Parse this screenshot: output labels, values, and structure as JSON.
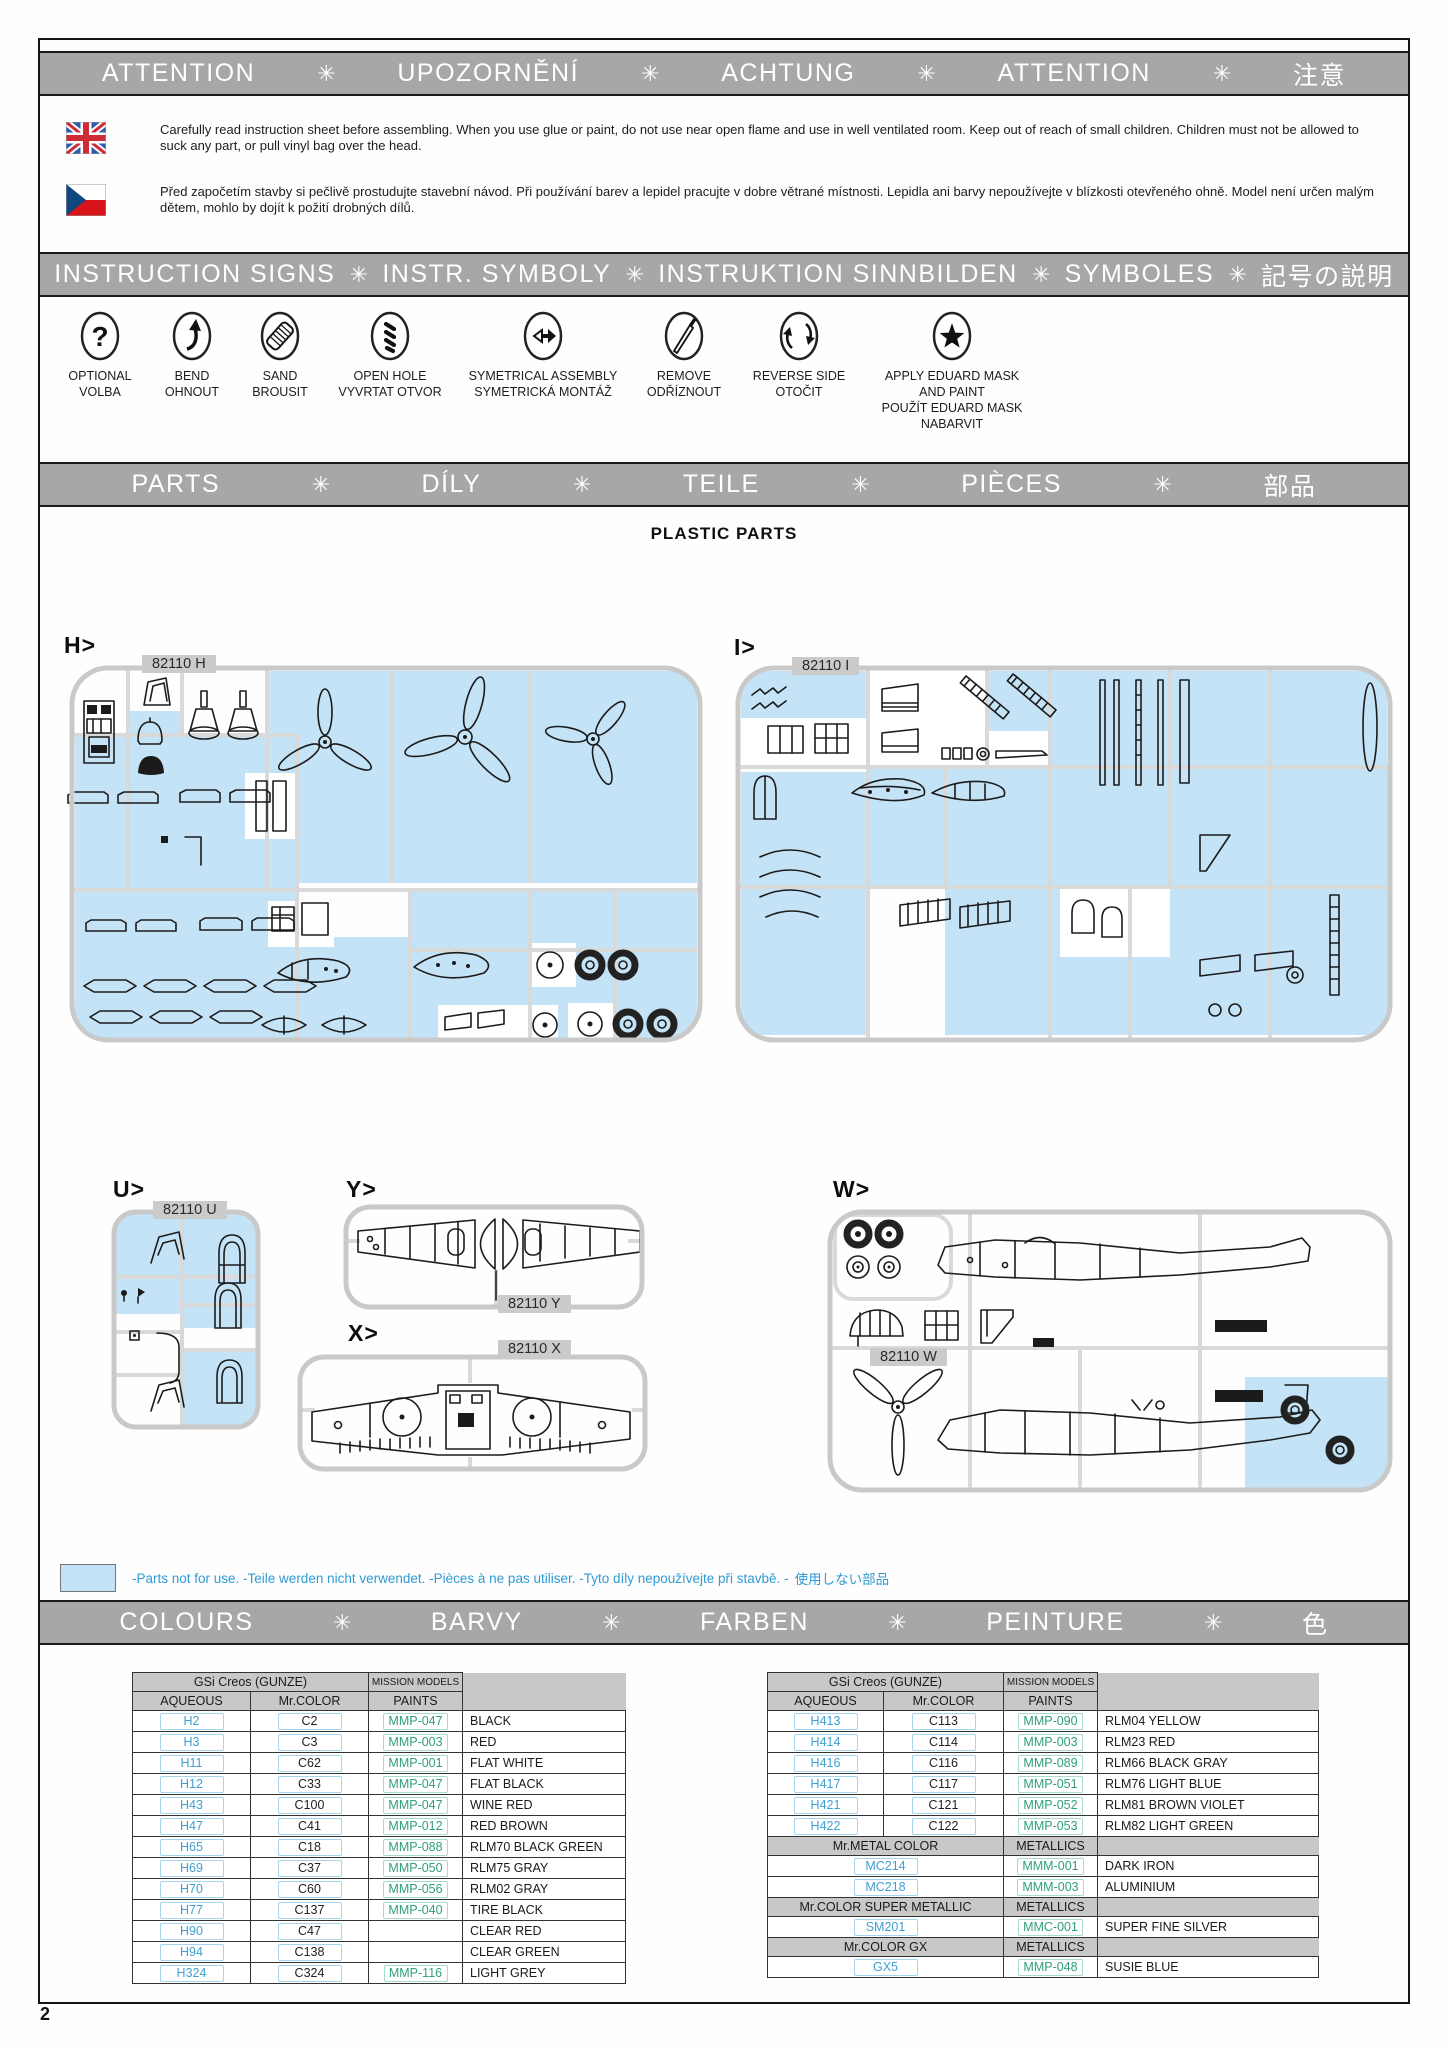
{
  "page_number": "2",
  "separator": "✳",
  "bars": {
    "attention": [
      "ATTENTION",
      "UPOZORNĚNÍ",
      "ACHTUNG",
      "ATTENTION",
      "注意"
    ],
    "instruction_signs": [
      "INSTRUCTION SIGNS",
      "INSTR. SYMBOLY",
      "INSTRUKTION  SINNBILDEN",
      "SYMBOLES",
      "記号の説明"
    ],
    "parts": [
      "PARTS",
      "DÍLY",
      "TEILE",
      "PIÈCES",
      "部品"
    ],
    "colours": [
      "COLOURS",
      "BARVY",
      "FARBEN",
      "PEINTURE",
      "色"
    ]
  },
  "warnings": {
    "english": "Carefully read instruction sheet before assembling. When you use glue or paint, do not use near open flame and use in well ventilated room. Keep out of reach of small children. Children must not be allowed to suck any part, or pull vinyl bag over the head.",
    "czech": "Před započetím stavby si pečlivě prostudujte stavební návod. Při používání barev a lepidel pracujte v dobre větrané místnosti. Lepidla ani barvy nepoužívejte v blízkosti otevřeného ohně. Model není určen malým dětem, mohlo by dojít k požití drobných dílů."
  },
  "signs": [
    {
      "id": "optional",
      "icon": "question-icon",
      "lines": [
        "OPTIONAL",
        "VOLBA"
      ]
    },
    {
      "id": "bend",
      "icon": "bend-arrow-icon",
      "lines": [
        "BEND",
        "OHNOUT"
      ]
    },
    {
      "id": "sand",
      "icon": "sanding-icon",
      "lines": [
        "SAND",
        "BROUSIT"
      ]
    },
    {
      "id": "open-hole",
      "icon": "drill-icon",
      "lines": [
        "OPEN HOLE",
        "VYVRTAT OTVOR"
      ]
    },
    {
      "id": "symmetrical-assembly",
      "icon": "symmetry-arrows-icon",
      "lines": [
        "SYMETRICAL ASSEMBLY",
        "SYMETRICKÁ MONTÁŽ"
      ]
    },
    {
      "id": "remove",
      "icon": "knife-icon",
      "lines": [
        "REMOVE",
        "ODŘÍZNOUT"
      ]
    },
    {
      "id": "reverse-side",
      "icon": "rotate-arrows-icon",
      "lines": [
        "REVERSE SIDE",
        "OTOČIT"
      ]
    },
    {
      "id": "apply-mask",
      "icon": "star-icon",
      "lines": [
        "APPLY EDUARD MASK",
        "AND PAINT",
        "POUŽÍT EDUARD MASK",
        "NABARVIT"
      ]
    }
  ],
  "parts_section": {
    "title": "PLASTIC PARTS",
    "sprues": [
      {
        "id": "h",
        "letter": "H>",
        "chip": "82110 H"
      },
      {
        "id": "i",
        "letter": "I>",
        "chip": "82110 I"
      },
      {
        "id": "u",
        "letter": "U>",
        "chip": "82110 U"
      },
      {
        "id": "y",
        "letter": "Y>",
        "chip": "82110 Y"
      },
      {
        "id": "x",
        "letter": "X>",
        "chip": "82110 X"
      },
      {
        "id": "w",
        "letter": "W>",
        "chip": "82110 W"
      }
    ],
    "note": "-Parts not for use. -Teile werden nicht verwendet. -Pièces à ne pas utiliser. -Tyto díly nepoužívejte při stavbě. -",
    "note_jp": "使用しない部品"
  },
  "paint_tables": {
    "left": {
      "group_header": "GSi Creos (GUNZE)",
      "brand_header": "MISSION MODELS",
      "columns": [
        "AQUEOUS",
        "Mr.COLOR",
        "PAINTS"
      ],
      "rows": [
        [
          "H2",
          "C2",
          "MMP-047",
          "BLACK"
        ],
        [
          "H3",
          "C3",
          "MMP-003",
          "RED"
        ],
        [
          "H11",
          "C62",
          "MMP-001",
          "FLAT WHITE"
        ],
        [
          "H12",
          "C33",
          "MMP-047",
          "FLAT BLACK"
        ],
        [
          "H43",
          "C100",
          "MMP-047",
          "WINE RED"
        ],
        [
          "H47",
          "C41",
          "MMP-012",
          "RED BROWN"
        ],
        [
          "H65",
          "C18",
          "MMP-088",
          "RLM70 BLACK GREEN"
        ],
        [
          "H69",
          "C37",
          "MMP-050",
          "RLM75 GRAY"
        ],
        [
          "H70",
          "C60",
          "MMP-056",
          "RLM02 GRAY"
        ],
        [
          "H77",
          "C137",
          "MMP-040",
          "TIRE BLACK"
        ],
        [
          "H90",
          "C47",
          "",
          "CLEAR RED"
        ],
        [
          "H94",
          "C138",
          "",
          "CLEAR GREEN"
        ],
        [
          "H324",
          "C324",
          "MMP-116",
          "LIGHT GREY"
        ]
      ]
    },
    "right": {
      "group_header": "GSi Creos (GUNZE)",
      "brand_header": "MISSION MODELS",
      "columns": [
        "AQUEOUS",
        "Mr.COLOR",
        "PAINTS"
      ],
      "rows": [
        [
          "H413",
          "C113",
          "MMP-090",
          "RLM04 YELLOW"
        ],
        [
          "H414",
          "C114",
          "MMP-003",
          "RLM23 RED"
        ],
        [
          "H416",
          "C116",
          "MMP-089",
          "RLM66 BLACK GRAY"
        ],
        [
          "H417",
          "C117",
          "MMP-051",
          "RLM76 LIGHT BLUE"
        ],
        [
          "H421",
          "C121",
          "MMP-052",
          "RLM81 BROWN VIOLET"
        ],
        [
          "H422",
          "C122",
          "MMP-053",
          "RLM82 LIGHT GREEN"
        ]
      ],
      "sections": [
        {
          "header": "Mr.METAL COLOR",
          "brand": "METALLICS",
          "rows": [
            [
              "MC214",
              "MMM-001",
              "DARK IRON"
            ],
            [
              "MC218",
              "MMM-003",
              "ALUMINIUM"
            ]
          ]
        },
        {
          "header": "Mr.COLOR SUPER METALLIC",
          "brand": "METALLICS",
          "rows": [
            [
              "SM201",
              "MMC-001",
              "SUPER FINE SILVER"
            ]
          ]
        },
        {
          "header": "Mr.COLOR GX",
          "brand": "METALLICS",
          "rows": [
            [
              "GX5",
              "MMP-048",
              "SUSIE BLUE"
            ]
          ]
        }
      ]
    }
  },
  "colors": {
    "bar_gray": "#a7a7a7",
    "highlight_blue": "#c5e3f6",
    "aqueous_blue": "#3f9fd0",
    "paints_green": "#2fa078",
    "note_blue": "#2f9bd6"
  }
}
